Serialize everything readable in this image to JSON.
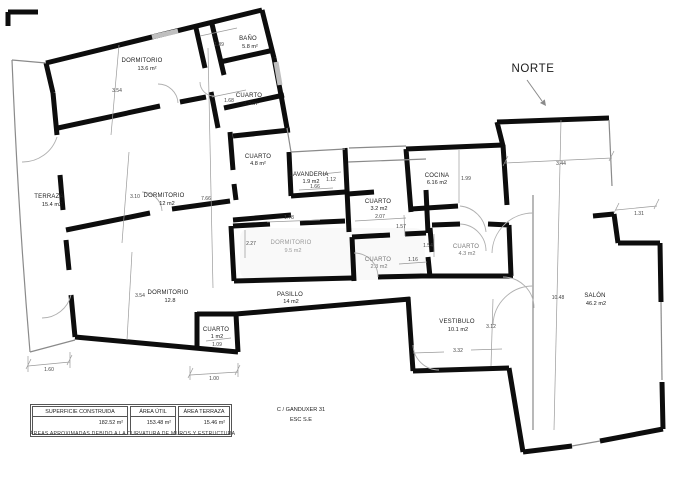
{
  "north": {
    "label": "NORTE"
  },
  "rooms": {
    "d136": {
      "n": "DORMITORIO",
      "a": "13.6 m²"
    },
    "bano": {
      "n": "BAÑO",
      "a": "5.8 m²"
    },
    "c33": {
      "n": "CUARTO",
      "a": "3.3 m²"
    },
    "terraza": {
      "n": "TERRAZA",
      "a": "15.4 m2"
    },
    "d12": {
      "n": "DORMITORIO",
      "a": "12 m2"
    },
    "d128": {
      "n": "DORMITORIO",
      "a": "12.8"
    },
    "c1": {
      "n": "CUARTO",
      "a": "1 m2"
    },
    "pasillo": {
      "n": "PASILLO",
      "a": "14 m2"
    },
    "c48": {
      "n": "CUARTO",
      "a": "4.8 m²"
    },
    "lav": {
      "n": "LAVANDERIA",
      "a": "1.9 m2"
    },
    "c32": {
      "n": "CUARTO",
      "a": "3.2 m2"
    },
    "d95": {
      "n": "DORMITORIO",
      "a": "9.5 m2"
    },
    "c23": {
      "n": "CUARTO",
      "a": "2.3 m2"
    },
    "cocina": {
      "n": "COCINA",
      "a": "6.16 m2"
    },
    "c43": {
      "n": "CUARTO",
      "a": "4.3 m2"
    },
    "vest": {
      "n": "VESTIBULO",
      "a": "10.1 m2"
    },
    "salon": {
      "n": "SALÓN",
      "a": "46.2 m2"
    }
  },
  "dims": {
    "v354a": "3.54",
    "v189": "1.89",
    "v168": "1.68",
    "v310": "3.10",
    "v766": "7.66",
    "v354b": "3.54",
    "v109": "1.09",
    "v160": "1.60",
    "v100": "1.00",
    "v112": "1.12",
    "v166": "1.66",
    "v207": "2.07",
    "v157": "1.57",
    "v227": "2.27",
    "v178": "1.78",
    "v154": "1.54",
    "v116": "1.16",
    "v199": "1.99",
    "v344": "3.44",
    "v131": "1.31",
    "v1048": "10.48",
    "v312": "3.12",
    "v332": "3.32"
  },
  "title_block": {
    "cols": [
      {
        "header": "SUPERFICIE CONSTRUIDA",
        "value": "182.52 m²"
      },
      {
        "header": "ÁREA ÚTIL",
        "value": "153.48 m²"
      },
      {
        "header": "ÁREA TERRAZA",
        "value": "15.46 m²"
      }
    ],
    "address": "C / GANDUXER 31",
    "scale": "ESC S.E",
    "note": "ÁREAS APROXIMADAS DEBIDO A LA CURVATURA DE MUROS Y ESTRUCTURA"
  }
}
